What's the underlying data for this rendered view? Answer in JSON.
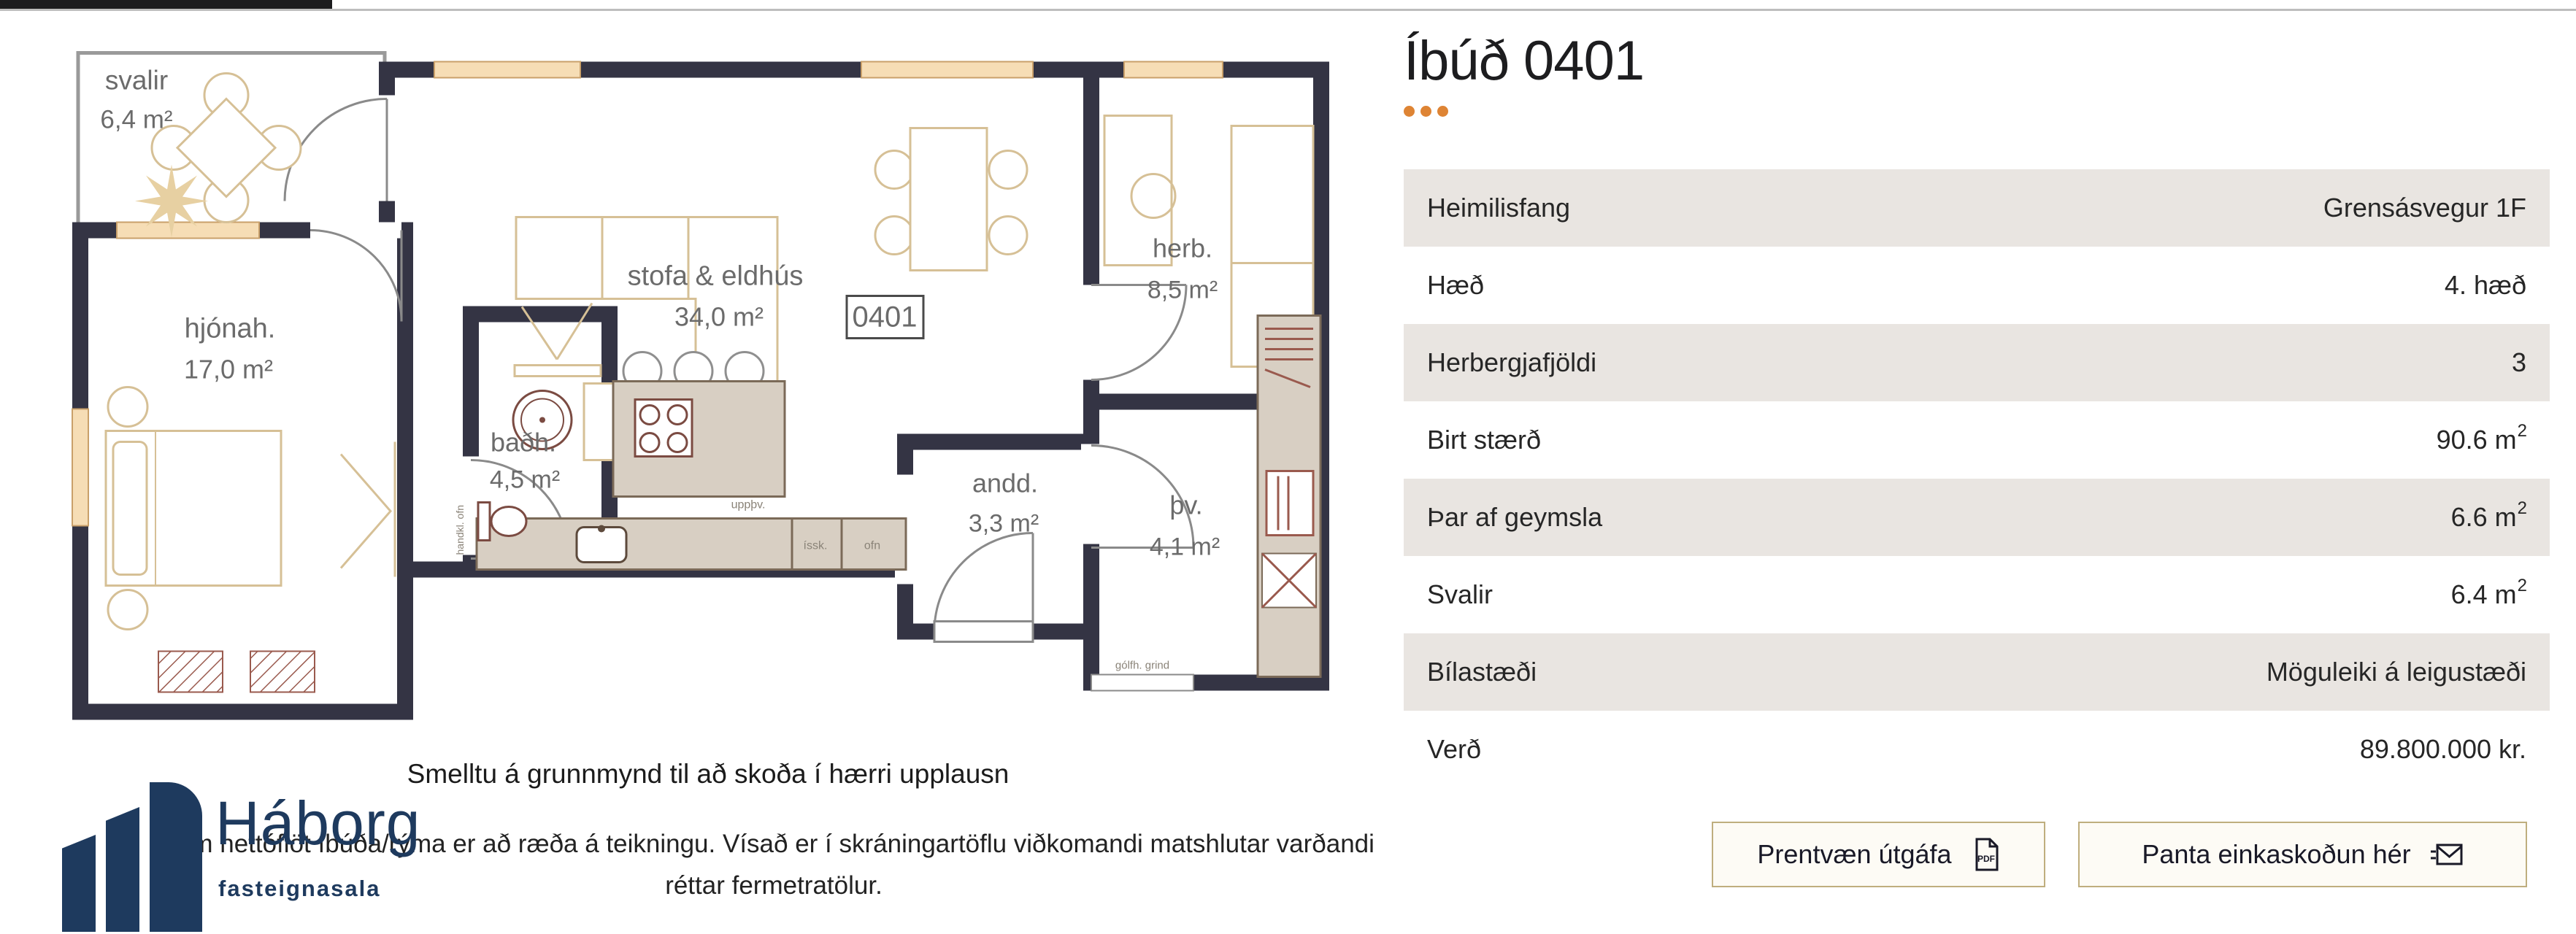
{
  "header": {
    "title": "Íbúð 0401"
  },
  "table": {
    "rows": [
      {
        "label": "Heimilisfang",
        "value": "Grensásvegur 1F",
        "sup": ""
      },
      {
        "label": "Hæð",
        "value": "4. hæð",
        "sup": ""
      },
      {
        "label": "Herbergjafjöldi",
        "value": "3",
        "sup": ""
      },
      {
        "label": "Birt stærð",
        "value": "90.6 m",
        "sup": "2"
      },
      {
        "label": "Þar af geymsla",
        "value": "6.6 m",
        "sup": "2"
      },
      {
        "label": "Svalir",
        "value": "6.4 m",
        "sup": "2"
      },
      {
        "label": "Bílastæði",
        "value": "Möguleiki á leigustæði",
        "sup": ""
      },
      {
        "label": "Verð",
        "value": "89.800.000 kr.",
        "sup": ""
      }
    ]
  },
  "buttons": {
    "print_label": "Prentvæn útgáfa",
    "book_label": "Panta einkaskoðun hér",
    "pdf_icon_text": "PDF"
  },
  "floorplan": {
    "unit_badge": "0401",
    "rooms": [
      {
        "name": "svalir",
        "size": "6,4 m²"
      },
      {
        "name": "hjónah.",
        "size": "17,0 m²"
      },
      {
        "name": "stofa & eldhús",
        "size": "34,0 m²"
      },
      {
        "name": "baðh.",
        "size": "4,5 m²"
      },
      {
        "name": "andd.",
        "size": "3,3 m²"
      },
      {
        "name": "herb.",
        "size": "8,5 m²"
      },
      {
        "name": "þv.",
        "size": "4,1 m²"
      }
    ],
    "small_labels": {
      "dishwasher": "uppþv.",
      "fridge": "íssk.",
      "oven": "ofn",
      "floor_grid": "gólfh. grind",
      "towel_radiator": "handkl. ofn"
    }
  },
  "captions": {
    "click_hint": "Smelltu á grunnmynd til að skoða í hærri upplausn",
    "disclaimer_line1": "Um nettóflöt íbúða/rýma er að ræða á teikningu. Vísað er í skráningartöflu viðkomandi matshlutar varðandi",
    "disclaimer_line2": "réttar fermetratölur."
  },
  "logo": {
    "name": "Háborg",
    "tagline": "fasteignasala"
  },
  "colors": {
    "accent_orange": "#de8434",
    "brand_navy": "#1e3a5e",
    "row_beige": "#e9e5e1",
    "wall_navy": "#343444",
    "button_border_gold": "#bfae7e"
  }
}
